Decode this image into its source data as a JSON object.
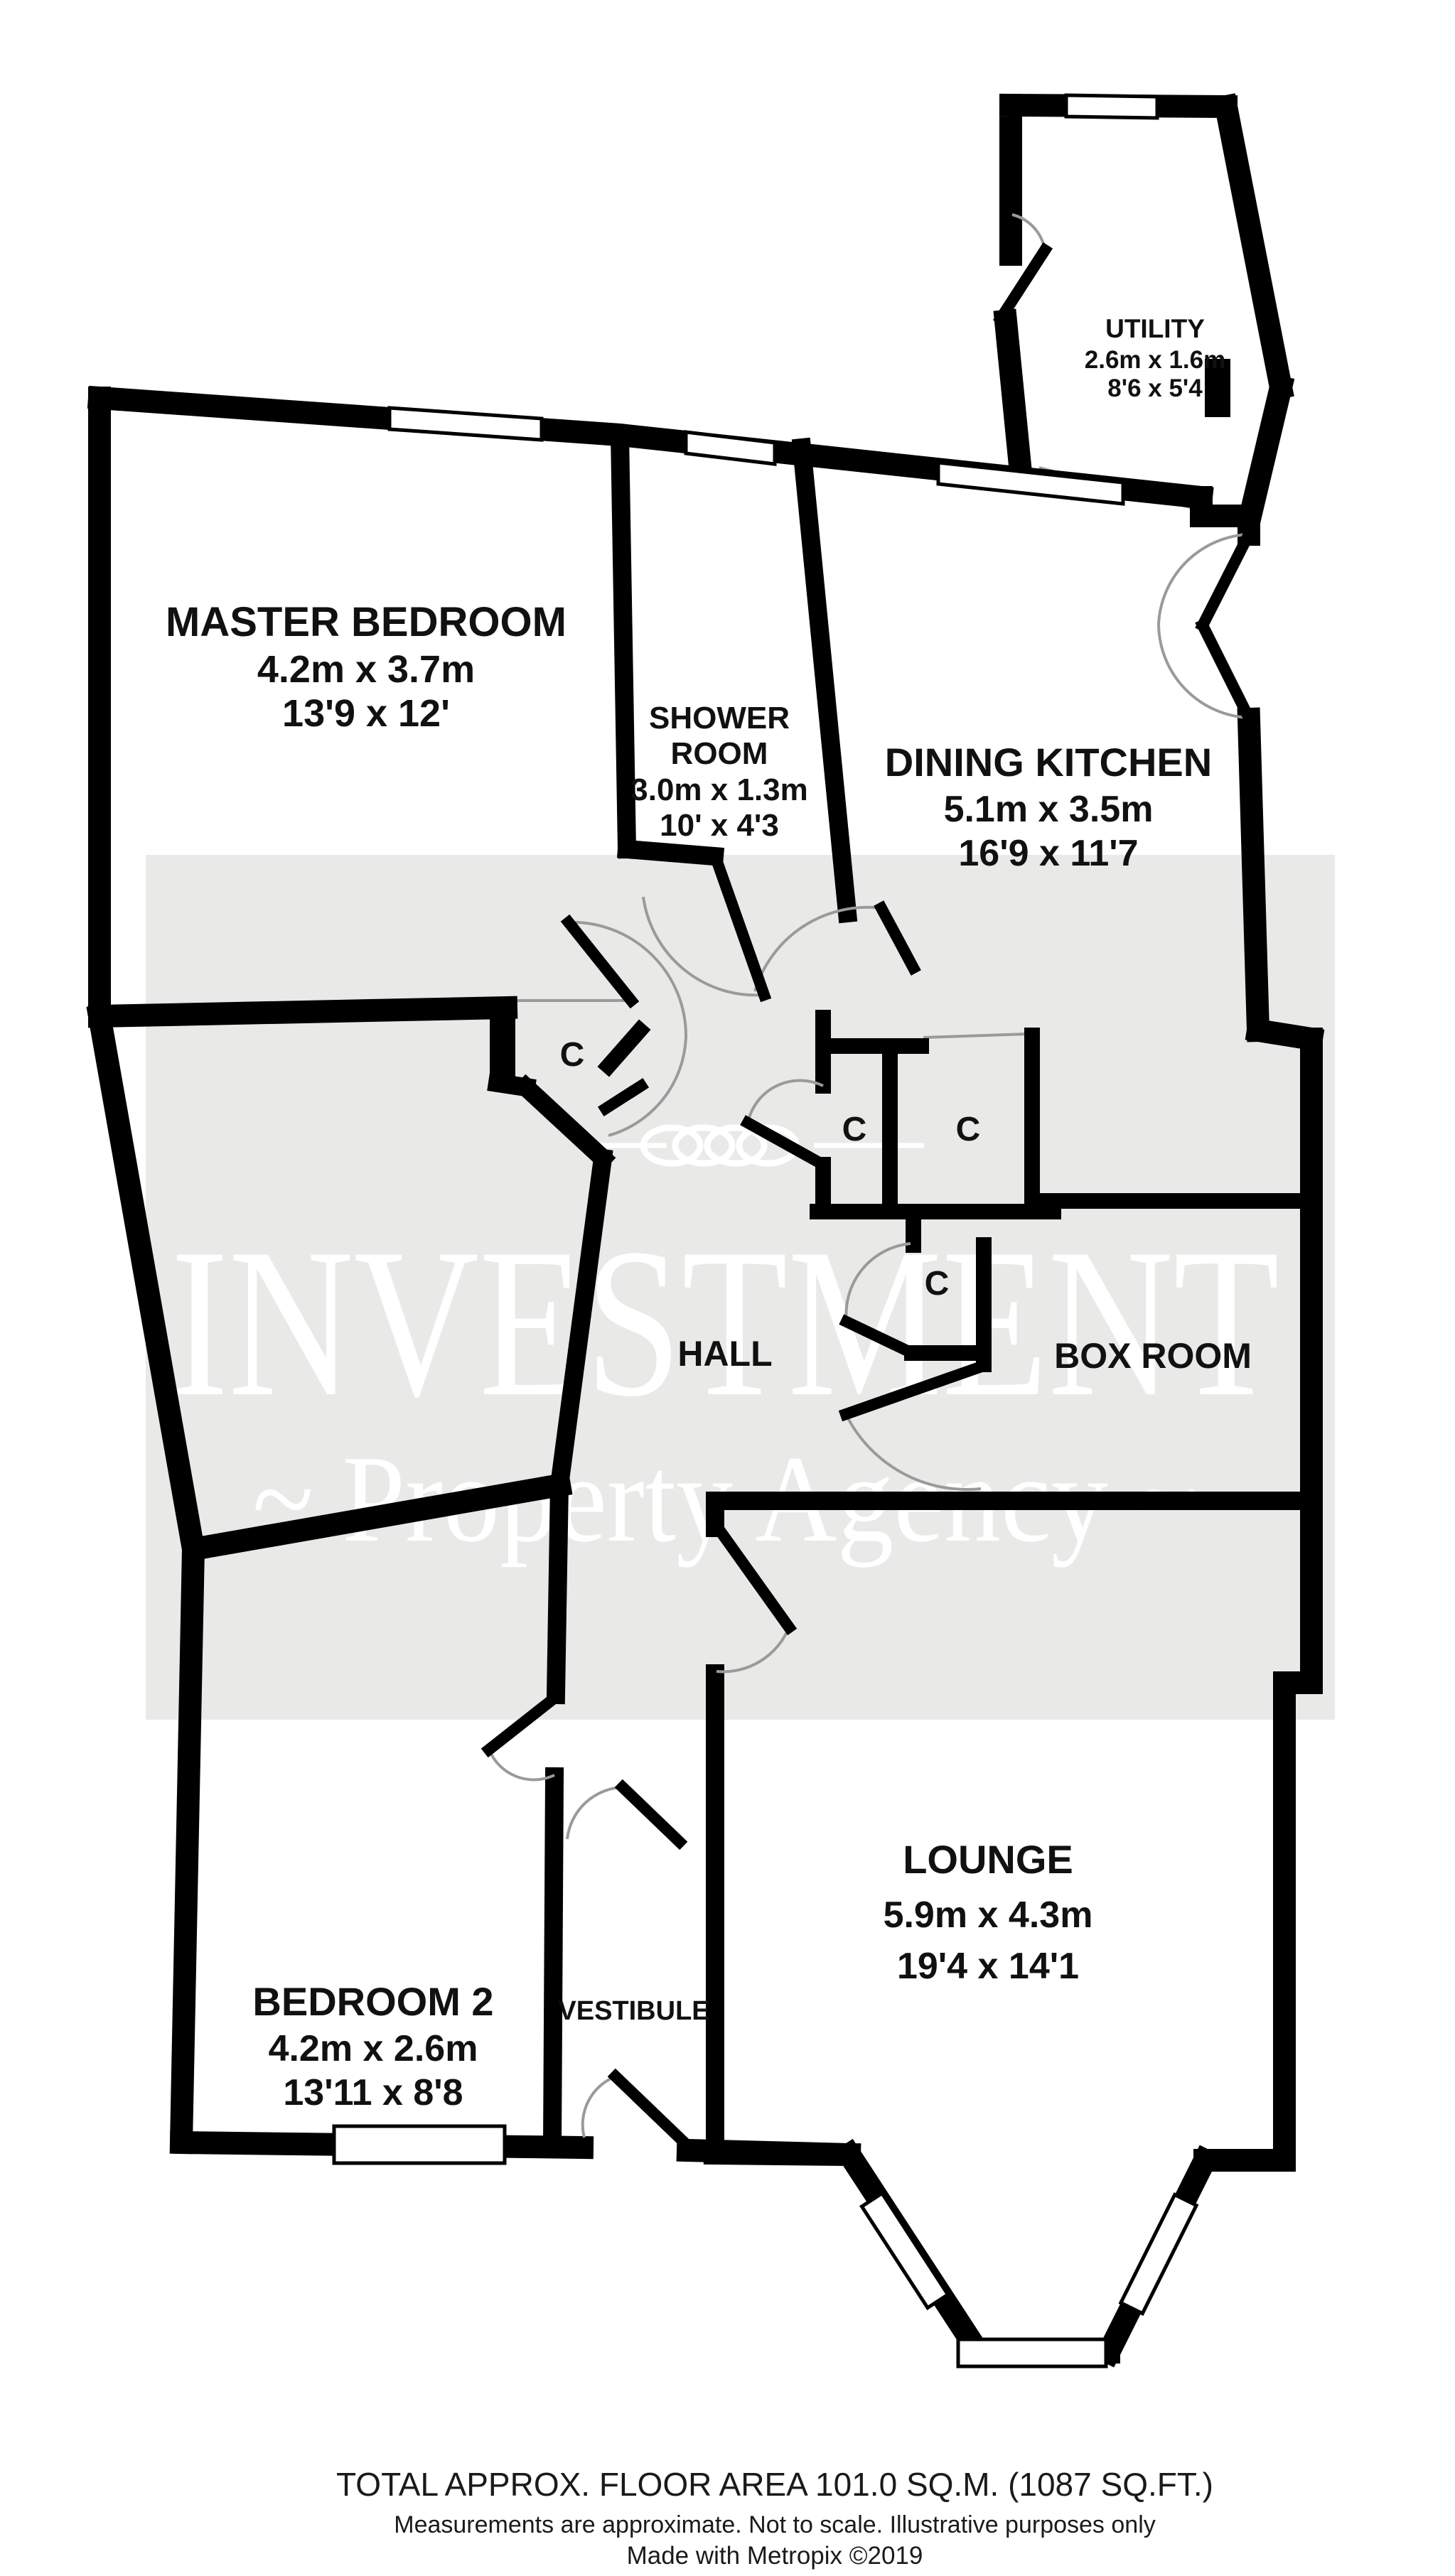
{
  "watermark": {
    "line1": "INVESTMENT",
    "line2": "~ Property Agency ~"
  },
  "rooms": [
    {
      "id": "master-bedroom",
      "lines": [
        "MASTER BEDROOM",
        "4.2m x 3.7m",
        "13'9 x 12'"
      ]
    },
    {
      "id": "shower-room",
      "lines": [
        "SHOWER",
        "ROOM",
        "3.0m x 1.3m",
        "10' x 4'3"
      ]
    },
    {
      "id": "dining-kitchen",
      "lines": [
        "DINING KITCHEN",
        "5.1m x 3.5m",
        "16'9 x 11'7"
      ]
    },
    {
      "id": "utility",
      "lines": [
        "UTILITY",
        "2.6m x 1.6m",
        "8'6 x 5'4"
      ]
    },
    {
      "id": "hall",
      "lines": [
        "HALL"
      ]
    },
    {
      "id": "box-room",
      "lines": [
        "BOX ROOM"
      ]
    },
    {
      "id": "vestibule",
      "lines": [
        "VESTIBULE"
      ]
    },
    {
      "id": "bedroom-2",
      "lines": [
        "BEDROOM 2",
        "4.2m x 2.6m",
        "13'11 x 8'8"
      ]
    },
    {
      "id": "lounge",
      "lines": [
        "LOUNGE",
        "5.9m x 4.3m",
        "19'4 x 14'1"
      ]
    }
  ],
  "closet_label": "C",
  "footer": {
    "line1": "TOTAL APPROX. FLOOR AREA 101.0 SQ.M. (1087 SQ.FT.)",
    "line2": "Measurements are approximate.  Not to scale.  Illustrative purposes only",
    "line3": "Made with Metropix ©2019"
  },
  "colors": {
    "background": "#ffffff",
    "wall": "#000000",
    "watermark_band": "#e9e9e8",
    "watermark_text": "#ffffff",
    "door_arc": "#9a9a9a",
    "label_text": "#111111"
  }
}
